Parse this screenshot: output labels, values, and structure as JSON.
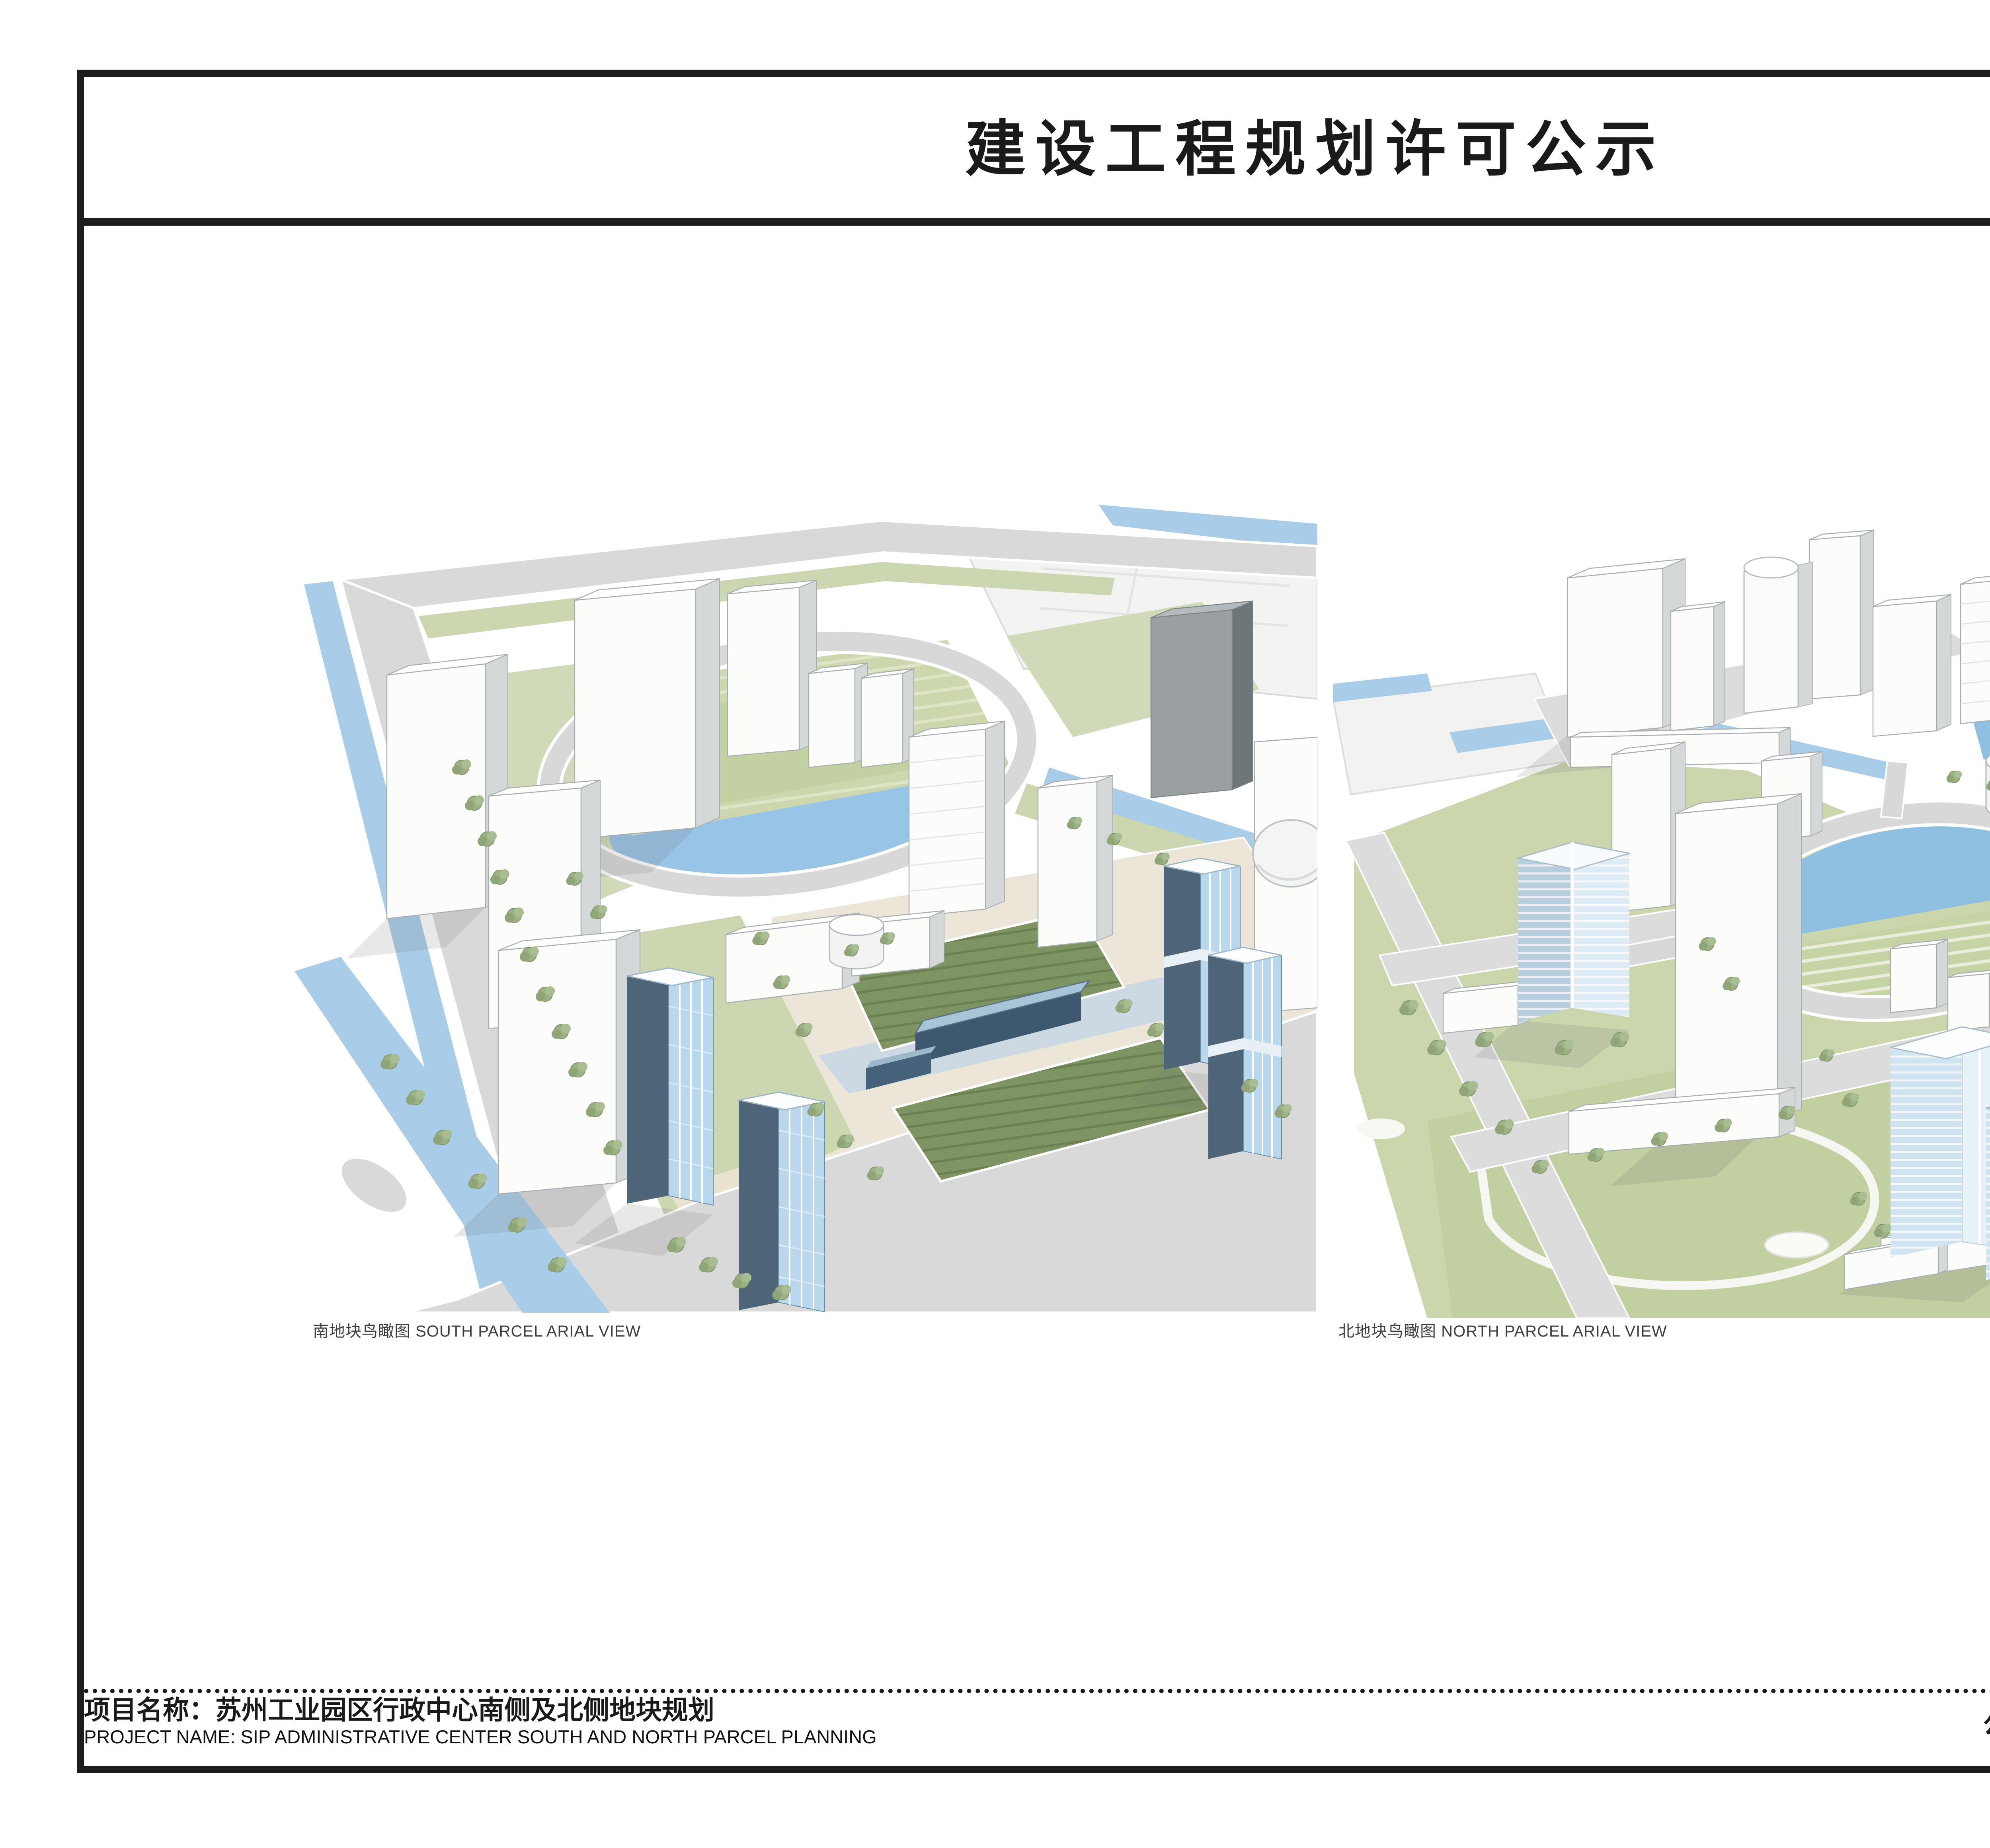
{
  "notice": {
    "title": "建设工程规划许可公示"
  },
  "figures": {
    "south": {
      "caption": "南地块鸟瞰图 SOUTH PARCEL ARIAL VIEW"
    },
    "north": {
      "caption": "北地块鸟瞰图 NORTH PARCEL ARIAL VIEW"
    }
  },
  "footer": {
    "project_zh": "项目名称：苏州工业园区行政中心南侧及北侧地块规划",
    "project_en": "PROJECT NAME: SIP ADMINISTRATIVE CENTER SOUTH AND NORTH PARCEL PLANNING",
    "period": "公示时间：2012年3月10日 — —2012年4月9日"
  },
  "palette": {
    "frame": "#1c1c1c",
    "road": "#d9d9d9",
    "water": "#a9cde9",
    "pond": "#8fc0e2",
    "lawn": "#ccd7ae",
    "lawn_dark": "#7e9463",
    "glass_light": "#b9d8ee",
    "glass_dark": "#4e6578",
    "building_white": "#fcfcfb"
  }
}
